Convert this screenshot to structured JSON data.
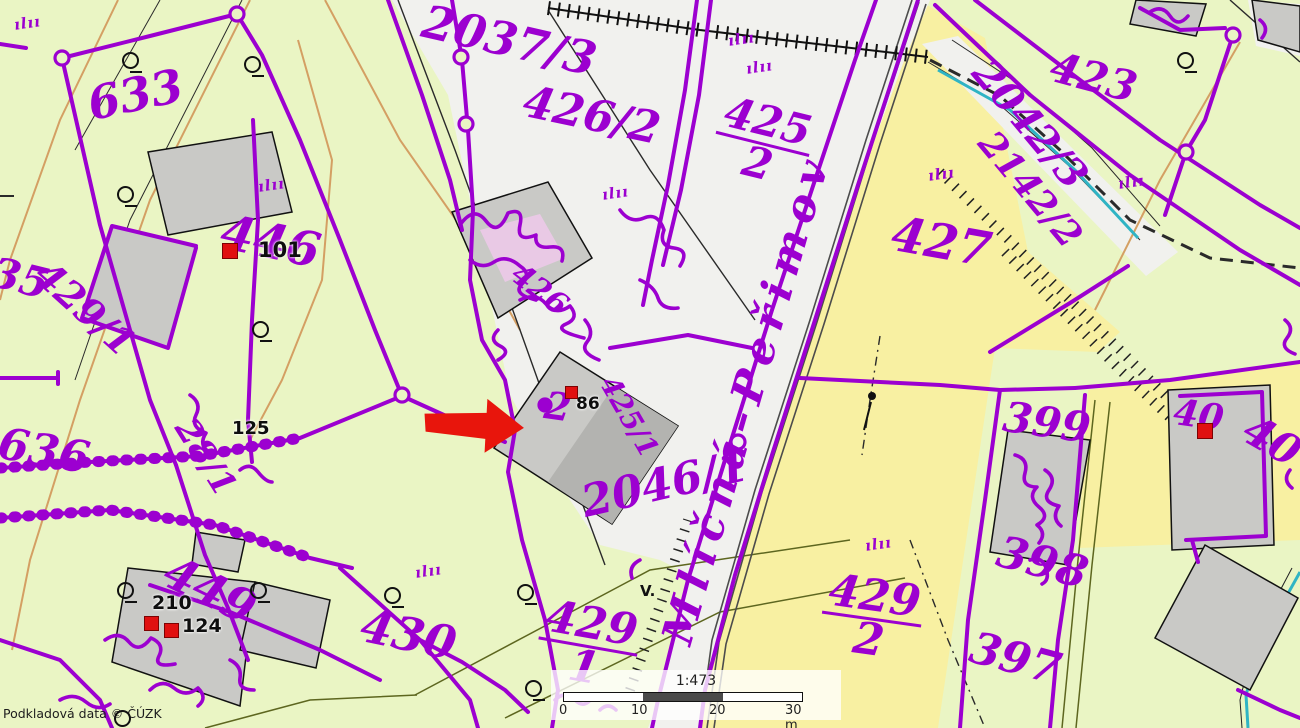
{
  "map": {
    "watermark": "Podkladová data © ČÚZK",
    "road_label": "Mlíčná–Peřimov",
    "colors": {
      "parcel_line": "#9c00d0",
      "arrow": "#e8150c",
      "building": "#c9c9c6",
      "meadow": "#eaf5c4",
      "field": "#f8f0a2",
      "road": "#f1f1ee",
      "stream": "#2fb4c4"
    },
    "scalebar": {
      "ratio": "1:473",
      "ticks": [
        "0",
        "10",
        "20",
        "30 m"
      ]
    },
    "labels": [
      {
        "n": "parcel-633",
        "t": "633",
        "x": 84,
        "y": 84,
        "r": -12,
        "s": 46
      },
      {
        "n": "parcel-2037-3",
        "t": "2037/3",
        "x": 428,
        "y": 0,
        "r": 13,
        "s": 46
      },
      {
        "n": "parcel-426-2",
        "t": "426/2",
        "x": 528,
        "y": 82,
        "r": 12,
        "s": 44
      },
      {
        "n": "parcel-425-2",
        "top": "425",
        "bot": "2",
        "x": 726,
        "y": 92,
        "r": 14,
        "s": 42
      },
      {
        "n": "parcel-423",
        "t": "423",
        "x": 1056,
        "y": 48,
        "r": 15,
        "s": 42
      },
      {
        "n": "parcel-2042-3",
        "t": "2042/3",
        "x": 994,
        "y": 54,
        "r": 50,
        "s": 40
      },
      {
        "n": "parcel-2142-2",
        "t": "2142/2",
        "x": 998,
        "y": 126,
        "r": 50,
        "s": 36
      },
      {
        "n": "parcel-446",
        "t": "446",
        "x": 226,
        "y": 210,
        "r": 12,
        "s": 48
      },
      {
        "n": "parcel-635",
        "t": "635",
        "x": -32,
        "y": 246,
        "r": 14,
        "s": 42
      },
      {
        "n": "parcel-429-1-left",
        "t": "429/1",
        "x": 52,
        "y": 256,
        "r": 42,
        "s": 38
      },
      {
        "n": "parcel-636",
        "t": "636",
        "x": 2,
        "y": 424,
        "r": 10,
        "s": 44
      },
      {
        "n": "parcel-28-1",
        "t": "28/1",
        "x": 196,
        "y": 414,
        "r": 58,
        "s": 34
      },
      {
        "n": "parcel-449",
        "t": "449",
        "x": 176,
        "y": 550,
        "r": 26,
        "s": 46
      },
      {
        "n": "parcel-430",
        "t": "430",
        "x": 366,
        "y": 604,
        "r": 12,
        "s": 46
      },
      {
        "n": "parcel-429-1",
        "top": "429",
        "bot": "1",
        "x": 546,
        "y": 596,
        "r": 10,
        "s": 44
      },
      {
        "n": "parcel-429-2",
        "top": "429",
        "bot": "2",
        "x": 828,
        "y": 570,
        "r": 8,
        "s": 44
      },
      {
        "n": "parcel-397",
        "t": "397",
        "x": 976,
        "y": 628,
        "r": 15,
        "s": 44
      },
      {
        "n": "parcel-398",
        "t": "398",
        "x": 1003,
        "y": 532,
        "r": 15,
        "s": 44
      },
      {
        "n": "parcel-399",
        "t": "399",
        "x": 1006,
        "y": 398,
        "r": 8,
        "s": 42
      },
      {
        "n": "parcel-427",
        "t": "427",
        "x": 896,
        "y": 212,
        "r": 10,
        "s": 48
      },
      {
        "n": "parcel-2046-1",
        "t": "2046/1",
        "x": 578,
        "y": 484,
        "r": -13,
        "s": 44
      },
      {
        "n": "parcel-40-building",
        "t": "40",
        "x": 1176,
        "y": 396,
        "r": 8,
        "s": 36
      },
      {
        "n": "parcel-40-edge",
        "t": "40",
        "x": 1256,
        "y": 410,
        "r": 30,
        "s": 42
      },
      {
        "n": "parcel-426-small",
        "t": "426",
        "x": 523,
        "y": 260,
        "r": 38,
        "s": 30
      },
      {
        "n": "parcel-425-1",
        "t": "425/1",
        "x": 618,
        "y": 372,
        "r": 60,
        "s": 28
      },
      {
        "n": "house-mark-glyph",
        "t": "2",
        "x": 547,
        "y": 388,
        "r": 8,
        "s": 38
      }
    ],
    "house_numbers": [
      {
        "n": "house-101",
        "t": "101",
        "x": 258,
        "y": 238,
        "s": 21
      },
      {
        "n": "house-125",
        "t": "125",
        "x": 232,
        "y": 418,
        "s": 18
      },
      {
        "n": "house-210",
        "t": "210",
        "x": 152,
        "y": 592,
        "s": 19
      },
      {
        "n": "house-124",
        "t": "124",
        "x": 182,
        "y": 615,
        "s": 19
      },
      {
        "n": "house-86",
        "t": "86",
        "x": 576,
        "y": 394,
        "s": 17
      }
    ],
    "red_markers": [
      {
        "x": 222,
        "y": 243,
        "s": 16
      },
      {
        "x": 144,
        "y": 616,
        "s": 15
      },
      {
        "x": 164,
        "y": 623,
        "s": 15
      },
      {
        "x": 565,
        "y": 386,
        "s": 13
      },
      {
        "x": 1197,
        "y": 423,
        "s": 16
      }
    ],
    "q_symbols": [
      [
        122,
        52
      ],
      [
        244,
        56
      ],
      [
        117,
        186
      ],
      [
        252,
        321
      ],
      [
        1177,
        52
      ],
      [
        517,
        584
      ],
      [
        117,
        582
      ],
      [
        250,
        582
      ],
      [
        114,
        710
      ],
      [
        384,
        587
      ],
      [
        525,
        680
      ]
    ],
    "grass_glyph": "ılıı",
    "grass_symbols": [
      [
        14,
        14
      ],
      [
        258,
        176
      ],
      [
        728,
        30
      ],
      [
        602,
        184
      ],
      [
        746,
        58
      ],
      [
        928,
        165
      ],
      [
        1118,
        173
      ],
      [
        865,
        535
      ],
      [
        415,
        562
      ]
    ],
    "v_symbols": [
      {
        "t": "V.",
        "x": 640,
        "y": 582
      }
    ]
  }
}
